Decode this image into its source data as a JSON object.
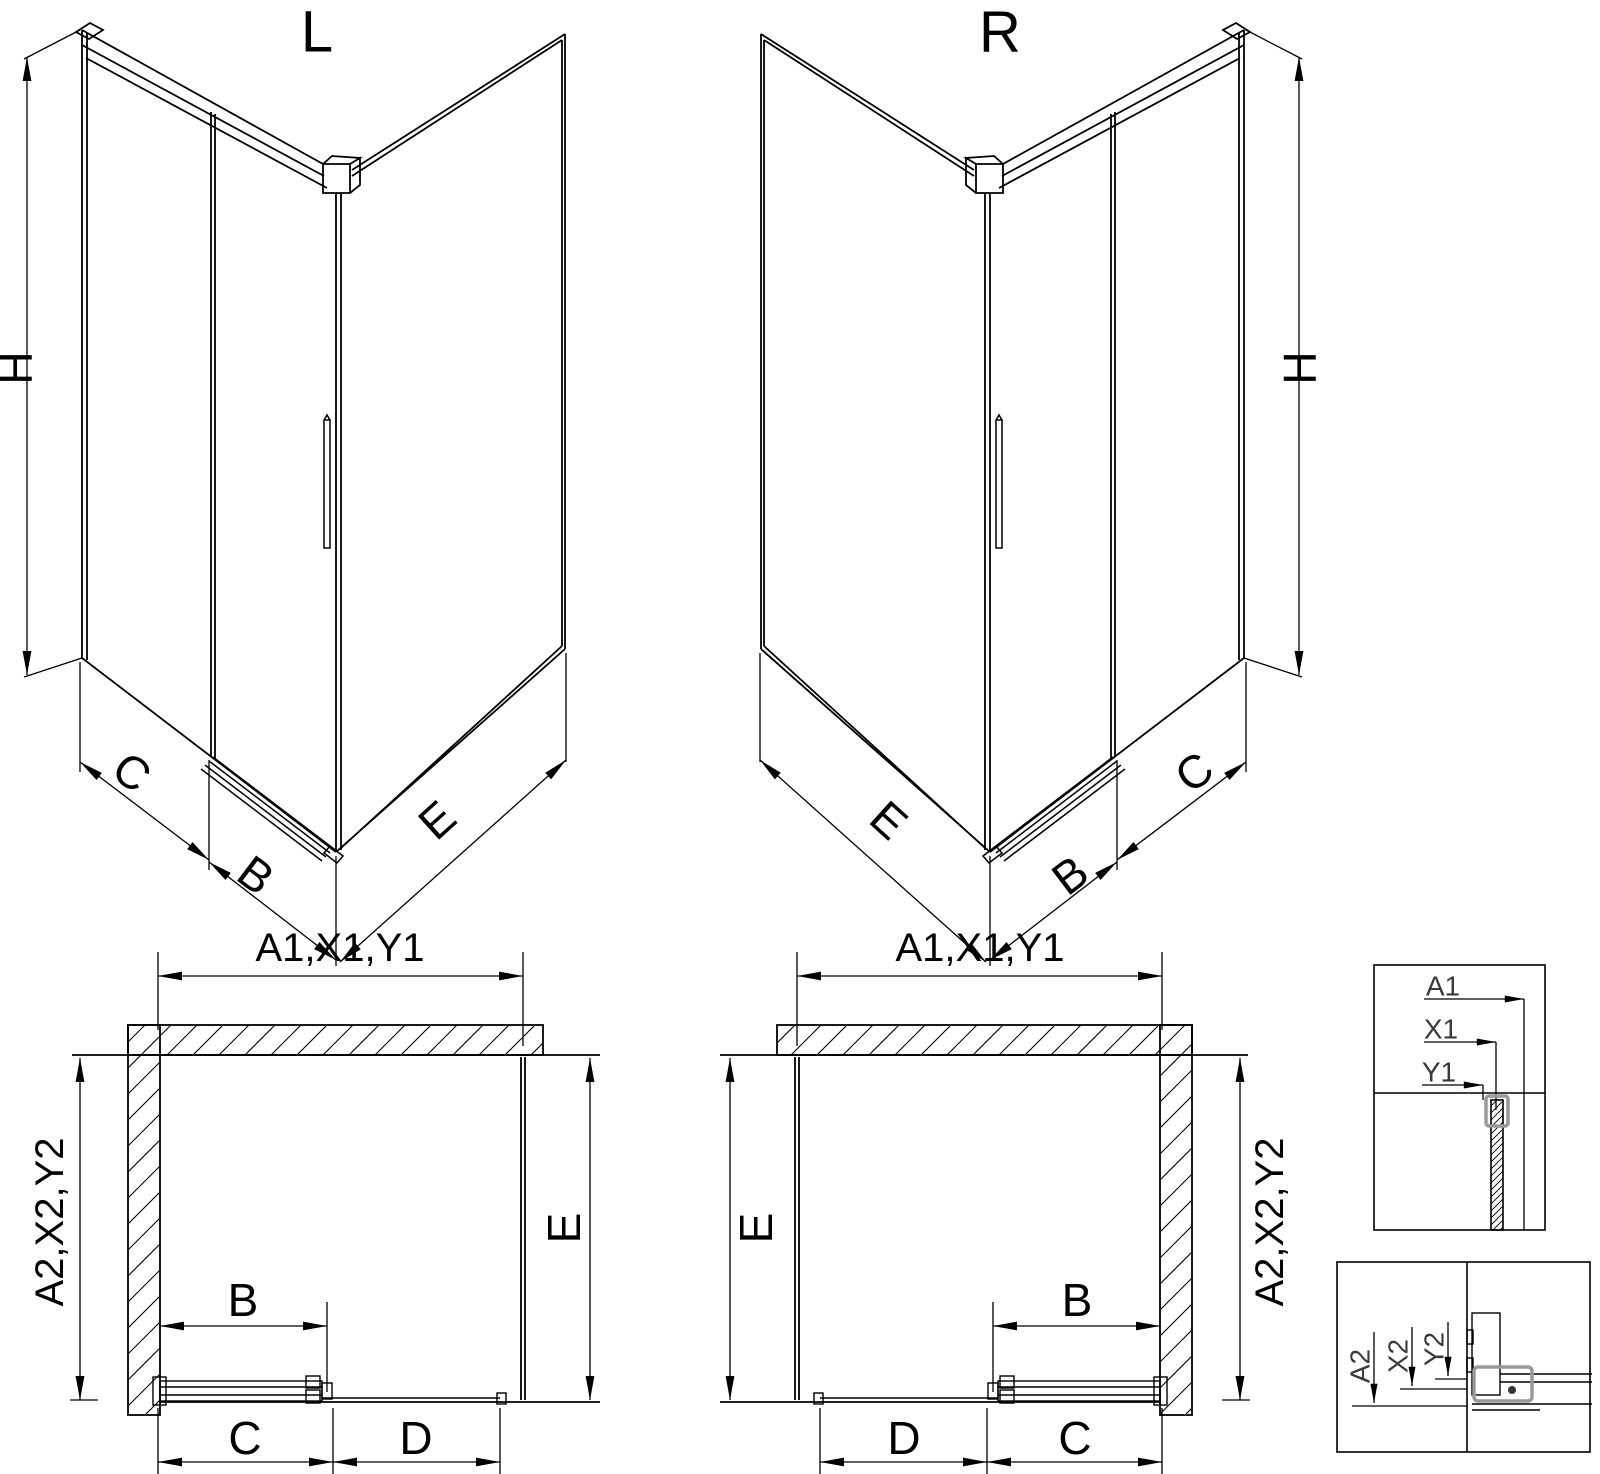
{
  "drawing": {
    "background": "#ffffff",
    "line_color": "#000000",
    "detail_label_color": "#3a3a3a",
    "hardware_color": "#999999"
  },
  "iso_left": {
    "title": "L",
    "dims": {
      "height": "H",
      "panel_c": "C",
      "door_b": "B",
      "side_e": "E"
    }
  },
  "iso_right": {
    "title": "R",
    "dims": {
      "height": "H",
      "panel_c": "C",
      "door_b": "B",
      "side_e": "E"
    }
  },
  "plan_left": {
    "dims": {
      "top": "A1,X1,Y1",
      "side": "A2,X2,Y2",
      "door_b": "B",
      "bottom_c": "C",
      "bottom_d": "D",
      "side_e": "E"
    }
  },
  "plan_right": {
    "dims": {
      "top": "A1,X1,Y1",
      "side": "A2,X2,Y2",
      "door_b": "B",
      "bottom_c": "C",
      "bottom_d": "D",
      "side_e": "E"
    }
  },
  "detail_top": {
    "dims": {
      "a": "A1",
      "x": "X1",
      "y": "Y1"
    }
  },
  "detail_bottom": {
    "dims": {
      "a": "A2",
      "x": "X2",
      "y": "Y2"
    }
  }
}
